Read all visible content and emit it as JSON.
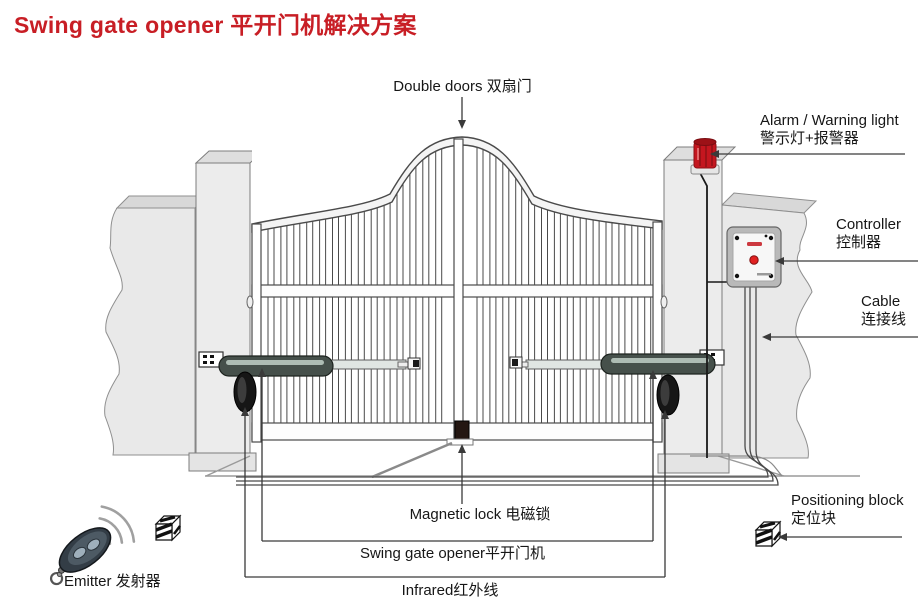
{
  "title": "Swing gate opener  平开门机解决方案",
  "labels": {
    "double_doors": "Double doors 双扇门",
    "alarm_en": "Alarm / Warning light",
    "alarm_zh": "警示灯+报警器",
    "controller_en": "Controller",
    "controller_zh": "控制器",
    "cable_en": "Cable",
    "cable_zh": "连接线",
    "positioning_en": "Positioning block",
    "positioning_zh": "定位块",
    "magnetic_lock": "Magnetic lock 电磁锁",
    "swing_gate_opener": "Swing gate opener平开门机",
    "infrared": "Infrared红外线",
    "emitter": "Emitter 发射器"
  },
  "icons": {
    "warning_light": "warning-light-icon",
    "controller_box": "controller-icon",
    "remote": "emitter-remote-icon",
    "radio_waves": "radio-waves-icon",
    "positioning_block": "positioning-block-icon",
    "photocell": "infrared-photocell-icon",
    "actuator": "swing-arm-actuator-icon",
    "magnetic_lock": "magnetic-lock-icon"
  },
  "colors": {
    "title_red": "#c81e25",
    "alarm_red": "#c4161f",
    "led_red": "#e02020",
    "wall_gray": "#e9e9e9",
    "line_dark": "#3a3a3a"
  }
}
